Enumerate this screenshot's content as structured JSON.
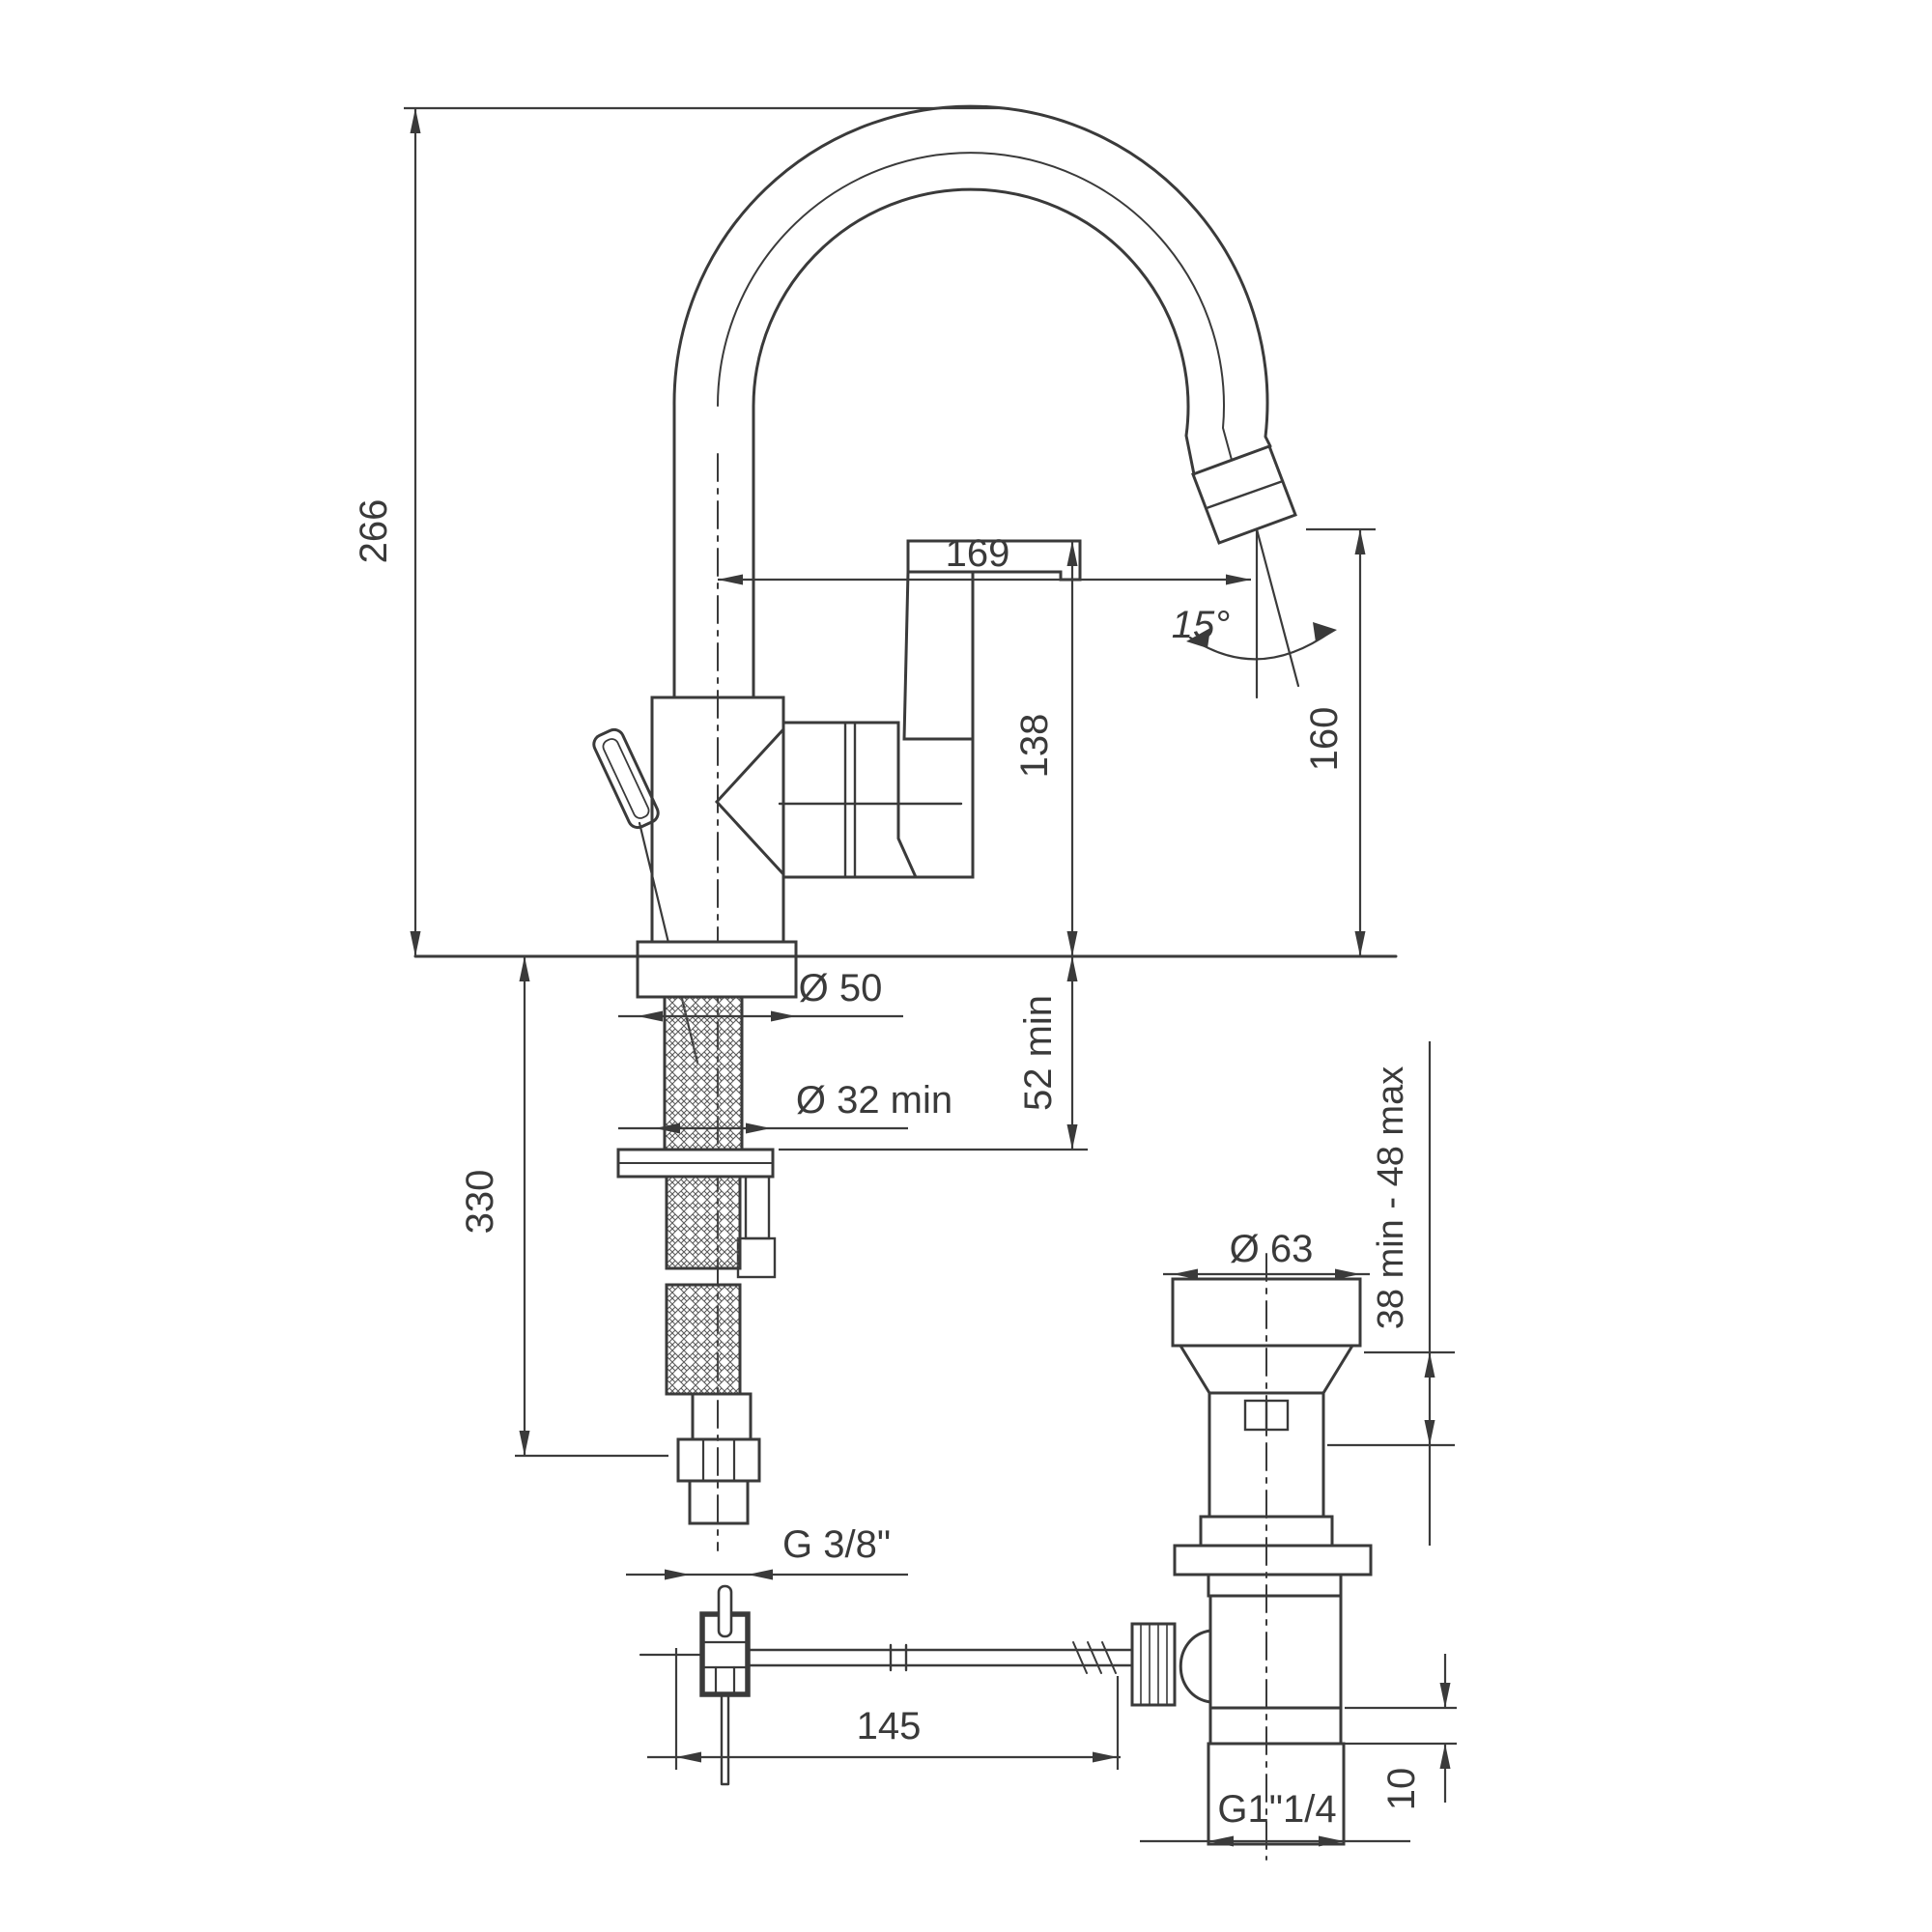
{
  "drawing": {
    "dims": {
      "overall_height": "266",
      "spout_reach": "169",
      "outlet_height": "160",
      "handle_height": "138",
      "outlet_angle": "15°",
      "base_diameter": "Ø 50",
      "mounting_hole": "Ø 32 min",
      "deck_clearance": "52 min",
      "hose_length": "330",
      "supply_thread": "G 3/8\"",
      "rod_to_drain": "145",
      "waste_cap_diameter": "Ø 63",
      "clamp_range": "38 min - 48 max",
      "waste_thread": "G1\"1/4",
      "waste_step": "10"
    }
  }
}
